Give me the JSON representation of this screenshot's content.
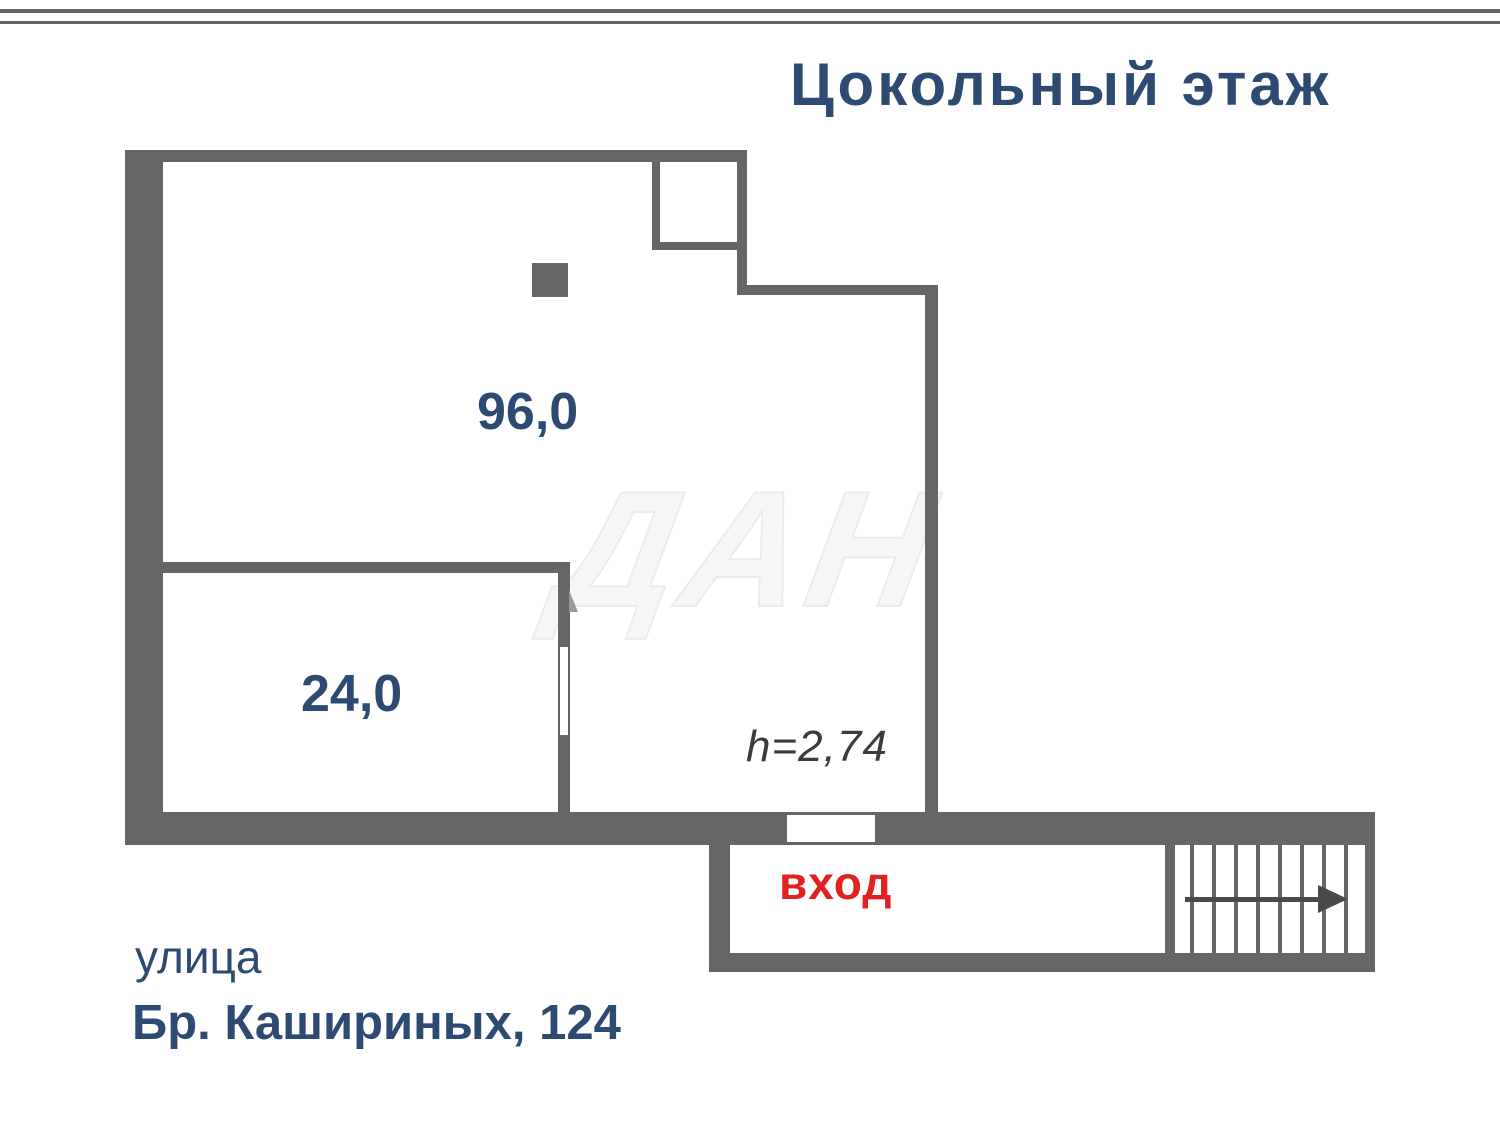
{
  "header": {
    "title": "Цокольный этаж"
  },
  "plan": {
    "large_room_area": "96,0",
    "small_room_area": "24,0",
    "ceiling_height": "h=2,74",
    "entrance_label": "вход",
    "stairs_steps": 8,
    "watermark": "ДАН"
  },
  "address": {
    "street_label": "улица",
    "street_value": "Бр. Кашириных, 124"
  },
  "colors": {
    "wall_gray": "#666666",
    "text_blue": "#2d4a73",
    "entrance_red": "#e02320",
    "height_text_gray": "#3b3b3b"
  }
}
